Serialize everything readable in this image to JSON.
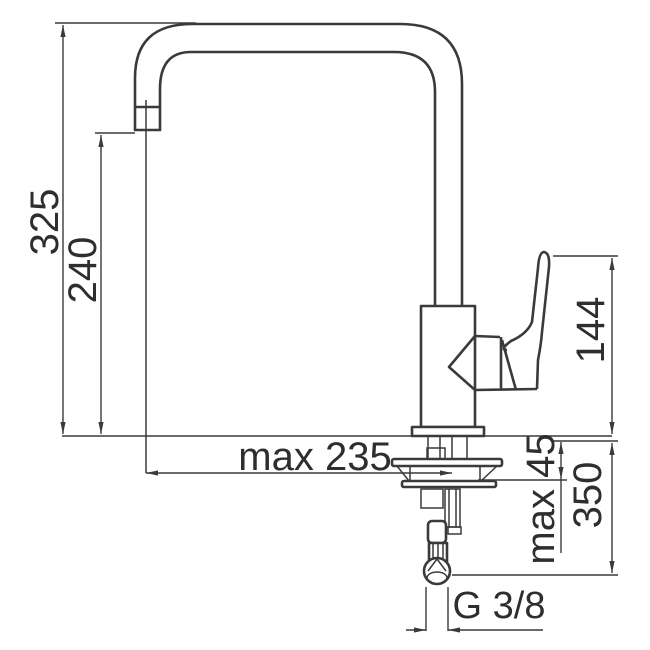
{
  "diagram": {
    "kind": "faucet-installation-drawing",
    "background_color": "#ffffff",
    "line_color": "#3a3a3a",
    "text_color": "#2e2e2e",
    "dimensions": {
      "overall_height": {
        "text": "325"
      },
      "spout_outlet_height": {
        "text": "240"
      },
      "handle_height": {
        "text": "144"
      },
      "spout_reach": {
        "text": "max 235"
      },
      "deck_thickness": {
        "text": "max 45"
      },
      "hose_length": {
        "text": "350"
      },
      "connection_thread": {
        "text": "G 3/8"
      }
    }
  }
}
